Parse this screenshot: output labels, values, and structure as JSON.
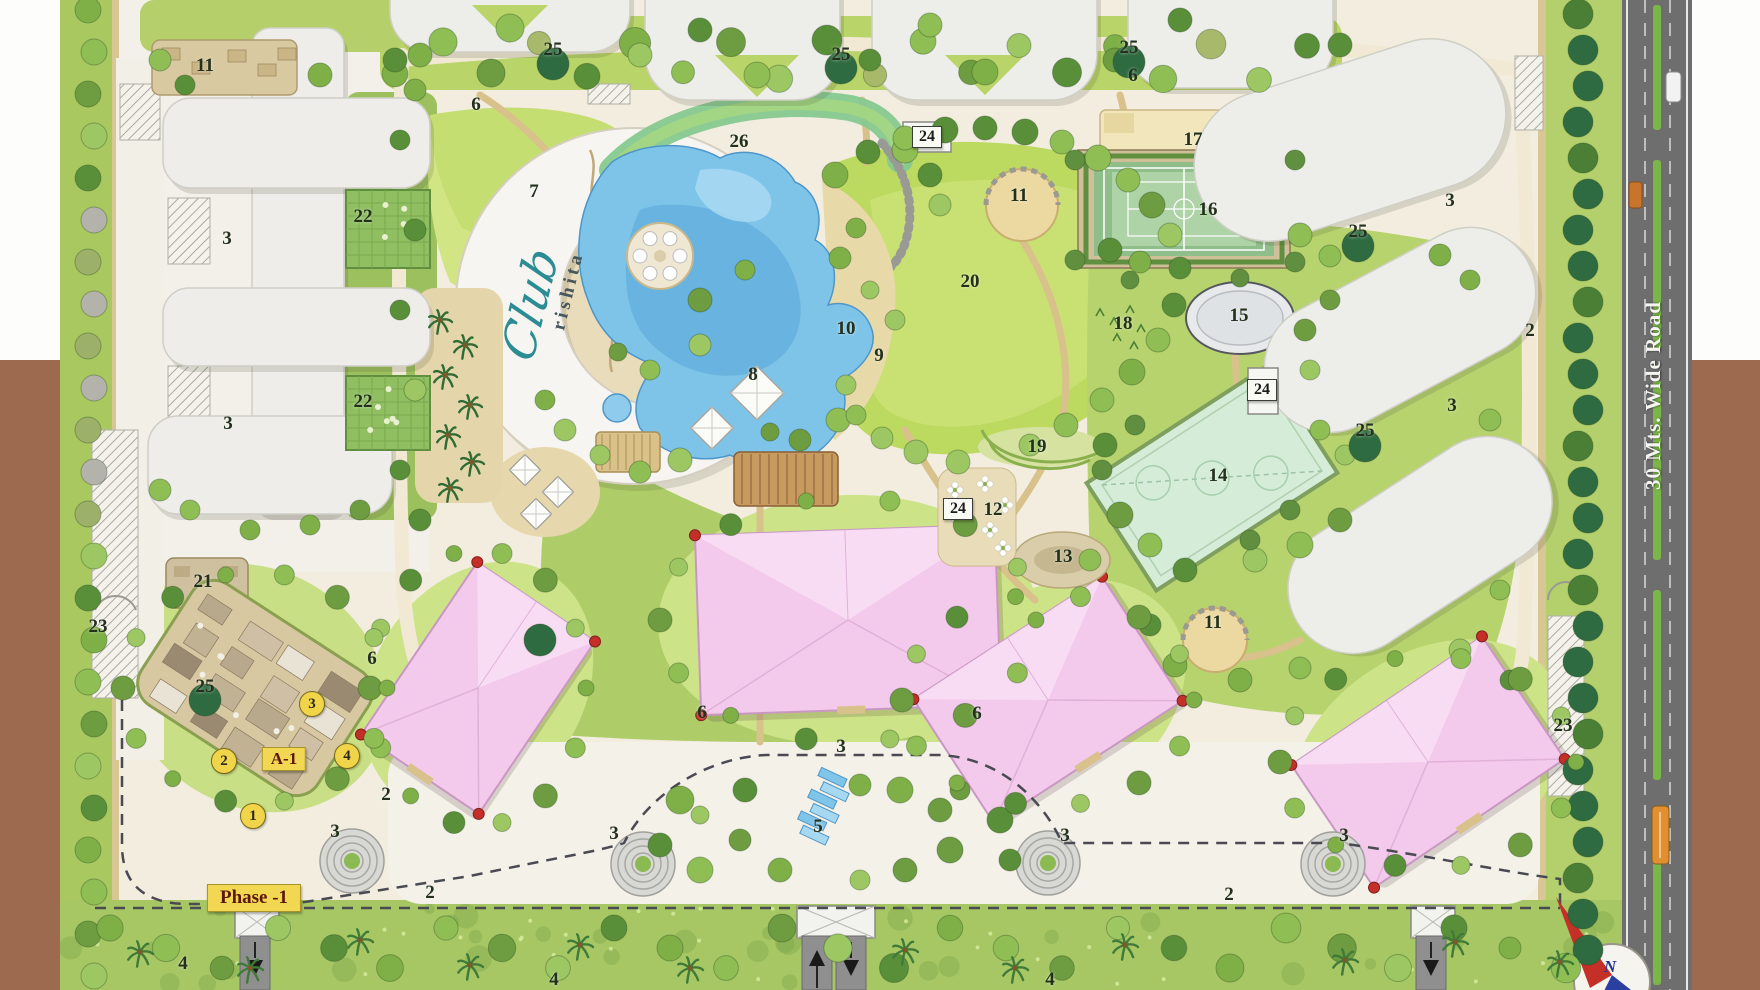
{
  "page": {
    "width": 1760,
    "height": 990
  },
  "site_plan": {
    "club_wordmark": {
      "script": "Club",
      "sub": "rishita"
    },
    "phase_tag": "Phase -1",
    "block_tag": "A-1",
    "road_label": "30 Mts. Wide Road",
    "compass_letter": "N",
    "colors": {
      "pool_blue": "#7ec4e9",
      "grass_light": "#b9d468",
      "grass_mid": "#9cc05e",
      "residence_pink": "#f3c9ec",
      "road_gray": "#6e6e6e",
      "margin_brown": "#9d6a50",
      "badge_yellow": "#f0d44a",
      "corner_red": "#c43027",
      "club_teal": "#2b8c93",
      "sand_tan": "#e6d8ac"
    },
    "number_labels": [
      {
        "text": "11",
        "x": 205,
        "y": 66
      },
      {
        "text": "25",
        "x": 553,
        "y": 50
      },
      {
        "text": "25",
        "x": 841,
        "y": 55
      },
      {
        "text": "25",
        "x": 1129,
        "y": 48
      },
      {
        "text": "6",
        "x": 476,
        "y": 105
      },
      {
        "text": "6",
        "x": 1133,
        "y": 76
      },
      {
        "text": "26",
        "x": 739,
        "y": 142
      },
      {
        "text": "7",
        "x": 534,
        "y": 192
      },
      {
        "text": "11",
        "x": 1019,
        "y": 196
      },
      {
        "text": "17",
        "x": 1193,
        "y": 140
      },
      {
        "text": "16",
        "x": 1208,
        "y": 210
      },
      {
        "text": "20",
        "x": 970,
        "y": 282
      },
      {
        "text": "15",
        "x": 1239,
        "y": 316
      },
      {
        "text": "18",
        "x": 1123,
        "y": 324
      },
      {
        "text": "10",
        "x": 846,
        "y": 329
      },
      {
        "text": "9",
        "x": 879,
        "y": 356
      },
      {
        "text": "8",
        "x": 753,
        "y": 375
      },
      {
        "text": "25",
        "x": 1358,
        "y": 232
      },
      {
        "text": "25",
        "x": 1365,
        "y": 431
      },
      {
        "text": "3",
        "x": 1450,
        "y": 201
      },
      {
        "text": "2",
        "x": 1530,
        "y": 331
      },
      {
        "text": "3",
        "x": 1452,
        "y": 406
      },
      {
        "text": "19",
        "x": 1037,
        "y": 447
      },
      {
        "text": "14",
        "x": 1218,
        "y": 476
      },
      {
        "text": "12",
        "x": 993,
        "y": 510
      },
      {
        "text": "13",
        "x": 1063,
        "y": 557
      },
      {
        "text": "11",
        "x": 1213,
        "y": 623
      },
      {
        "text": "22",
        "x": 363,
        "y": 217
      },
      {
        "text": "22",
        "x": 363,
        "y": 402
      },
      {
        "text": "3",
        "x": 227,
        "y": 239
      },
      {
        "text": "3",
        "x": 228,
        "y": 424
      },
      {
        "text": "21",
        "x": 203,
        "y": 582
      },
      {
        "text": "25",
        "x": 205,
        "y": 687
      },
      {
        "text": "23",
        "x": 98,
        "y": 627
      },
      {
        "text": "23",
        "x": 1563,
        "y": 726
      },
      {
        "text": "6",
        "x": 372,
        "y": 659
      },
      {
        "text": "6",
        "x": 702,
        "y": 713
      },
      {
        "text": "6",
        "x": 977,
        "y": 714
      },
      {
        "text": "3",
        "x": 841,
        "y": 747
      },
      {
        "text": "2",
        "x": 386,
        "y": 795
      },
      {
        "text": "3",
        "x": 614,
        "y": 834
      },
      {
        "text": "3",
        "x": 335,
        "y": 832
      },
      {
        "text": "3",
        "x": 1065,
        "y": 836
      },
      {
        "text": "3",
        "x": 1344,
        "y": 836
      },
      {
        "text": "5",
        "x": 818,
        "y": 827
      },
      {
        "text": "2",
        "x": 430,
        "y": 893
      },
      {
        "text": "2",
        "x": 1229,
        "y": 895
      },
      {
        "text": "4",
        "x": 183,
        "y": 964
      },
      {
        "text": "4",
        "x": 554,
        "y": 980
      },
      {
        "text": "4",
        "x": 1050,
        "y": 980
      }
    ],
    "sign_labels": [
      {
        "text": "24",
        "x": 927,
        "y": 137
      },
      {
        "text": "24",
        "x": 1262,
        "y": 390
      },
      {
        "text": "24",
        "x": 958,
        "y": 509
      }
    ],
    "unit_badges": [
      {
        "text": "1",
        "x": 253,
        "y": 816
      },
      {
        "text": "2",
        "x": 224,
        "y": 761
      },
      {
        "text": "3",
        "x": 312,
        "y": 704
      },
      {
        "text": "4",
        "x": 347,
        "y": 756
      }
    ]
  }
}
